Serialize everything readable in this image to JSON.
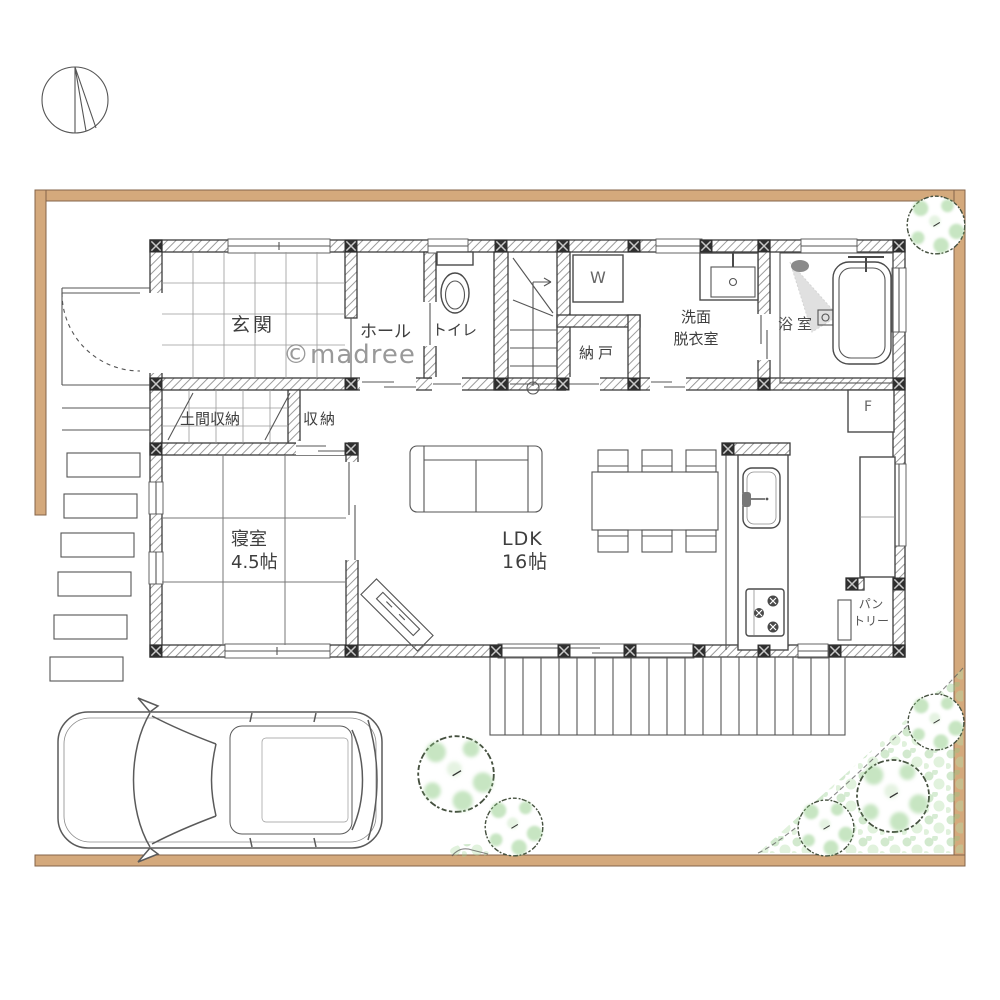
{
  "watermark": "©madree",
  "rooms": {
    "genkan": "玄関",
    "hall": "ホール",
    "toilet": "トイレ",
    "washer": "W",
    "nando": "納戸",
    "senmen1": "洗面",
    "senmen2": "脱衣室",
    "bath": "浴室",
    "doma": "土間収納",
    "closet": "収納",
    "bedroom": "寝室",
    "bedroom_size": "4.5帖",
    "ldk": "LDK",
    "ldk_size": "16帖",
    "pantry1": "パン",
    "pantry2": "トリー",
    "fridge": "F"
  },
  "colors": {
    "site_boundary": "#d4a97c",
    "boundary_edge": "#84644a",
    "tree_green": "#8ec984",
    "ink": "#4a4a4a",
    "watermark_gray": "#8f8f8f"
  }
}
